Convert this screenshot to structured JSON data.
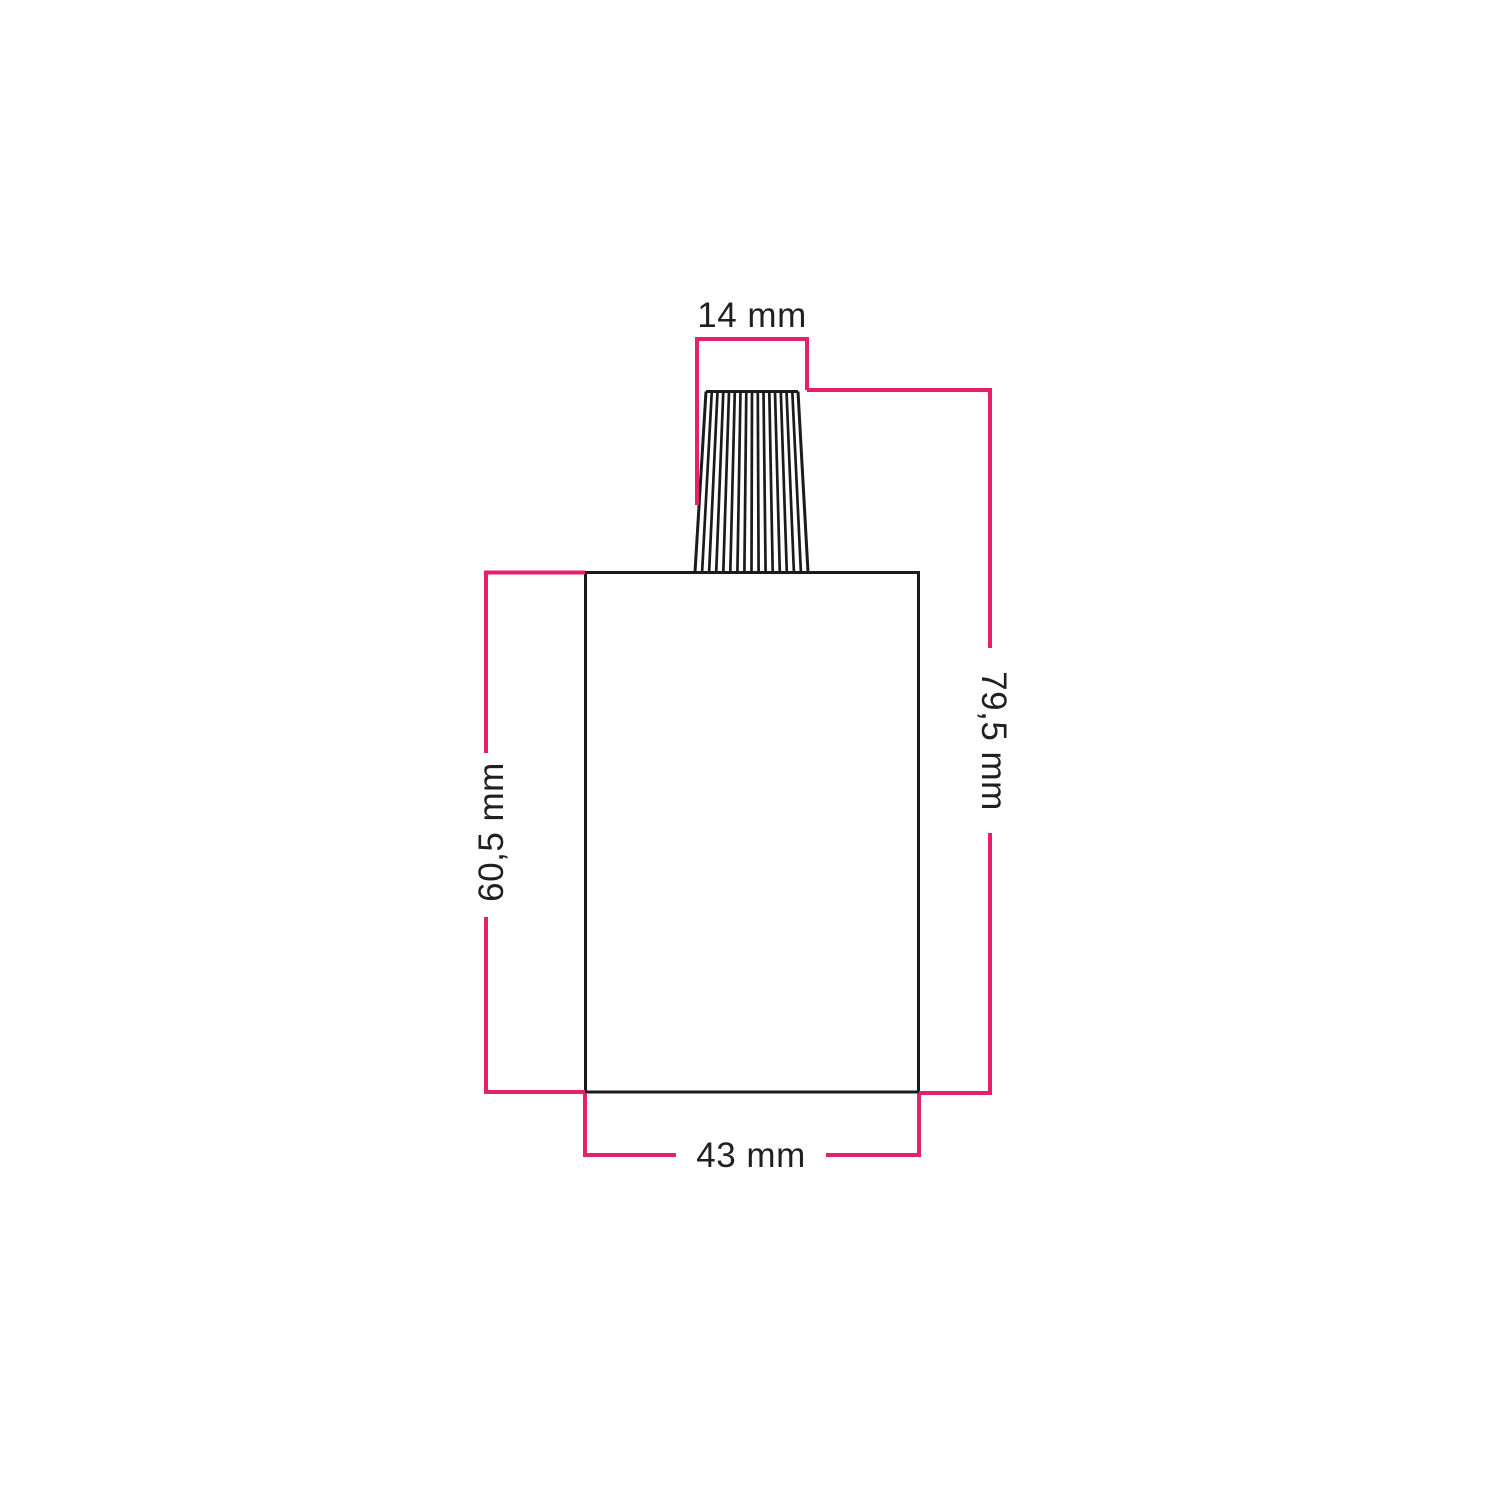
{
  "diagram": {
    "labels": {
      "gland_width": "14 mm",
      "total_height": "79,5 mm",
      "body_height": "60,5 mm",
      "body_width": "43 mm"
    },
    "colors": {
      "dimension_line": "#e6216b",
      "outline": "#1b1b1b",
      "label_text": "#231f20",
      "background": "#ffffff"
    }
  }
}
